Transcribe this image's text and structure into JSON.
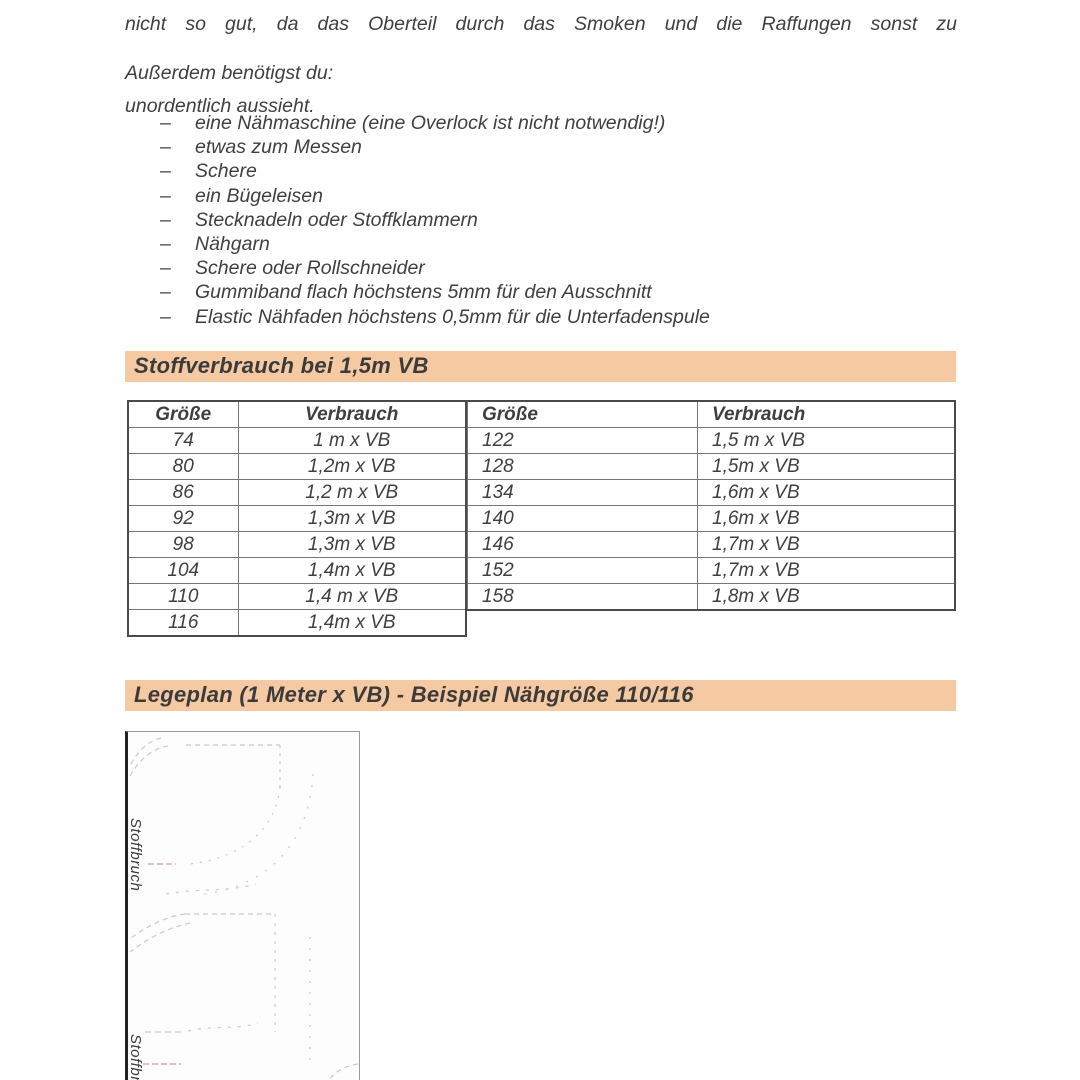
{
  "bullet_char": "–",
  "intro": {
    "line1": "nicht so gut, da das Oberteil durch das Smoken und die Raffungen sonst zu",
    "line2": "unordentlich aussieht."
  },
  "needs_heading": "Außerdem benötigst du:",
  "needs_items": [
    "eine Nähmaschine (eine Overlock ist nicht notwendig!)",
    "etwas zum Messen",
    "Schere",
    "ein Bügeleisen",
    "Stecknadeln oder Stoffklammern",
    "Nähgarn",
    "Schere oder Rollschneider",
    "Gummiband flach höchstens 5mm für den Ausschnitt",
    "Elastic Nähfaden höchstens 0,5mm für die Unterfadenspule"
  ],
  "section1": {
    "title": "Stoffverbrauch bei 1,5m VB",
    "table_left": {
      "headers": [
        "Größe",
        "Verbrauch"
      ],
      "rows": [
        [
          "74",
          "1 m x VB"
        ],
        [
          "80",
          "1,2m x VB"
        ],
        [
          "86",
          "1,2 m x VB"
        ],
        [
          "92",
          "1,3m x VB"
        ],
        [
          "98",
          "1,3m x VB"
        ],
        [
          "104",
          "1,4m x VB"
        ],
        [
          "110",
          "1,4 m x VB"
        ],
        [
          "116",
          "1,4m x VB"
        ]
      ]
    },
    "table_right": {
      "headers": [
        "Größe",
        "Verbrauch"
      ],
      "rows": [
        [
          "122",
          "1,5 m x VB"
        ],
        [
          "128",
          "1,5m x VB"
        ],
        [
          "134",
          "1,6m x VB"
        ],
        [
          "140",
          "1,6m x VB"
        ],
        [
          "146",
          "1,7m x VB"
        ],
        [
          "152",
          "1,7m x VB"
        ],
        [
          "158",
          "1,8m x VB"
        ]
      ]
    }
  },
  "section2": {
    "title": "Legeplan (1 Meter x VB) - Beispiel Nähgröße 110/116",
    "diagram": {
      "fold_label_top": "Stoffbruch",
      "fold_label_bottom": "Stoffbruch"
    }
  },
  "colors": {
    "heading_bg": "#f5c9a2",
    "text": "#3f3f3f",
    "pattern_line": "#cfc8c8",
    "fold_line_pink": "#dda6a6",
    "table_outer_border": "#4a4a4a",
    "table_inner_border": "#767676"
  }
}
